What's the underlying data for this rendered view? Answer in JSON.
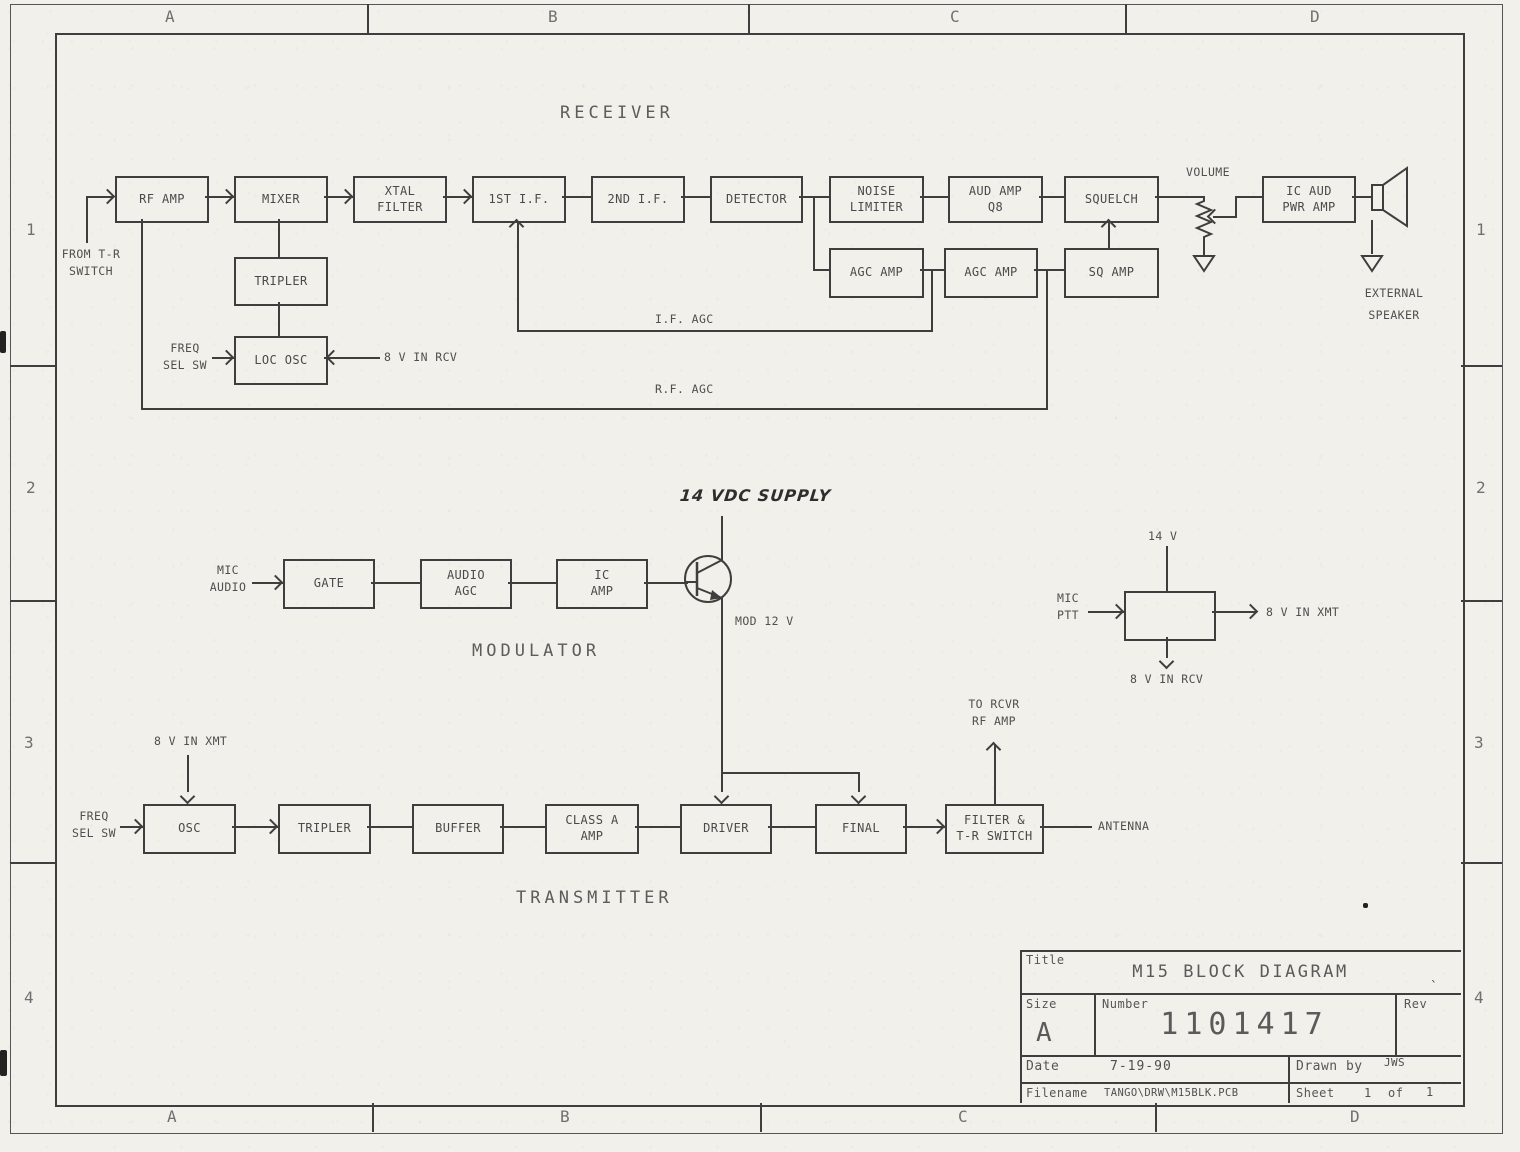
{
  "border": {
    "cols": [
      "A",
      "B",
      "C",
      "D"
    ],
    "rows": [
      "1",
      "2",
      "3",
      "4"
    ]
  },
  "receiver": {
    "heading": "RECEIVER",
    "blocks": {
      "rf_amp": "RF AMP",
      "mixer": "MIXER",
      "xtal_filter": "XTAL\nFILTER",
      "first_if": "1ST I.F.",
      "second_if": "2ND I.F.",
      "detector": "DETECTOR",
      "noise_limiter": "NOISE\nLIMITER",
      "aud_amp": "AUD AMP\nQ8",
      "squelch": "SQUELCH",
      "ic_aud_pwr_amp": "IC AUD\nPWR AMP",
      "tripler": "TRIPLER",
      "agc_amp_1": "AGC AMP",
      "agc_amp_2": "AGC AMP",
      "sq_amp": "SQ AMP",
      "loc_osc": "LOC OSC"
    },
    "labels": {
      "from_tr_switch": "FROM T-R\nSWITCH",
      "freq_sel_sw": "FREQ\nSEL SW",
      "v8_in_rcv": "8 V IN RCV",
      "if_agc": "I.F. AGC",
      "rf_agc": "R.F. AGC",
      "volume": "VOLUME",
      "external_speaker": "EXTERNAL\nSPEAKER"
    }
  },
  "modulator": {
    "heading": "MODULATOR",
    "supply": "14 VDC SUPPLY",
    "blocks": {
      "gate": "GATE",
      "audio_agc": "AUDIO\nAGC",
      "ic_amp": "IC\nAMP"
    },
    "labels": {
      "mic_audio": "MIC\nAUDIO",
      "mod_12v": "MOD 12 V"
    }
  },
  "ptt": {
    "labels": {
      "v14": "14 V",
      "mic_ptt": "MIC\nPTT",
      "v8_xmt": "8 V IN XMT",
      "v8_rcv": "8 V IN RCV"
    }
  },
  "transmitter": {
    "heading": "TRANSMITTER",
    "blocks": {
      "osc": "OSC",
      "tripler": "TRIPLER",
      "buffer": "BUFFER",
      "class_a_amp": "CLASS A\nAMP",
      "driver": "DRIVER",
      "final": "FINAL",
      "filter_tr": "FILTER &\nT-R SWITCH"
    },
    "labels": {
      "freq_sel_sw": "FREQ\nSEL SW",
      "v8_in_xmt": "8 V IN XMT",
      "to_rcvr": "TO RCVR\nRF AMP",
      "antenna": "ANTENNA"
    }
  },
  "title_block": {
    "title_label": "Title",
    "title": "M15 BLOCK DIAGRAM",
    "size_label": "Size",
    "size": "A",
    "number_label": "Number",
    "number": "1101417",
    "rev_label": "Rev",
    "rev_mark": "`",
    "date_label": "Date",
    "date": "7-19-90",
    "drawn_by_label": "Drawn by",
    "drawn_by": "JWS",
    "filename_label": "Filename",
    "filename": "TANGO\\DRW\\M15BLK.PCB",
    "sheet_label": "Sheet",
    "sheet_number": "1",
    "of_label": "of",
    "sheet_total": "1"
  }
}
